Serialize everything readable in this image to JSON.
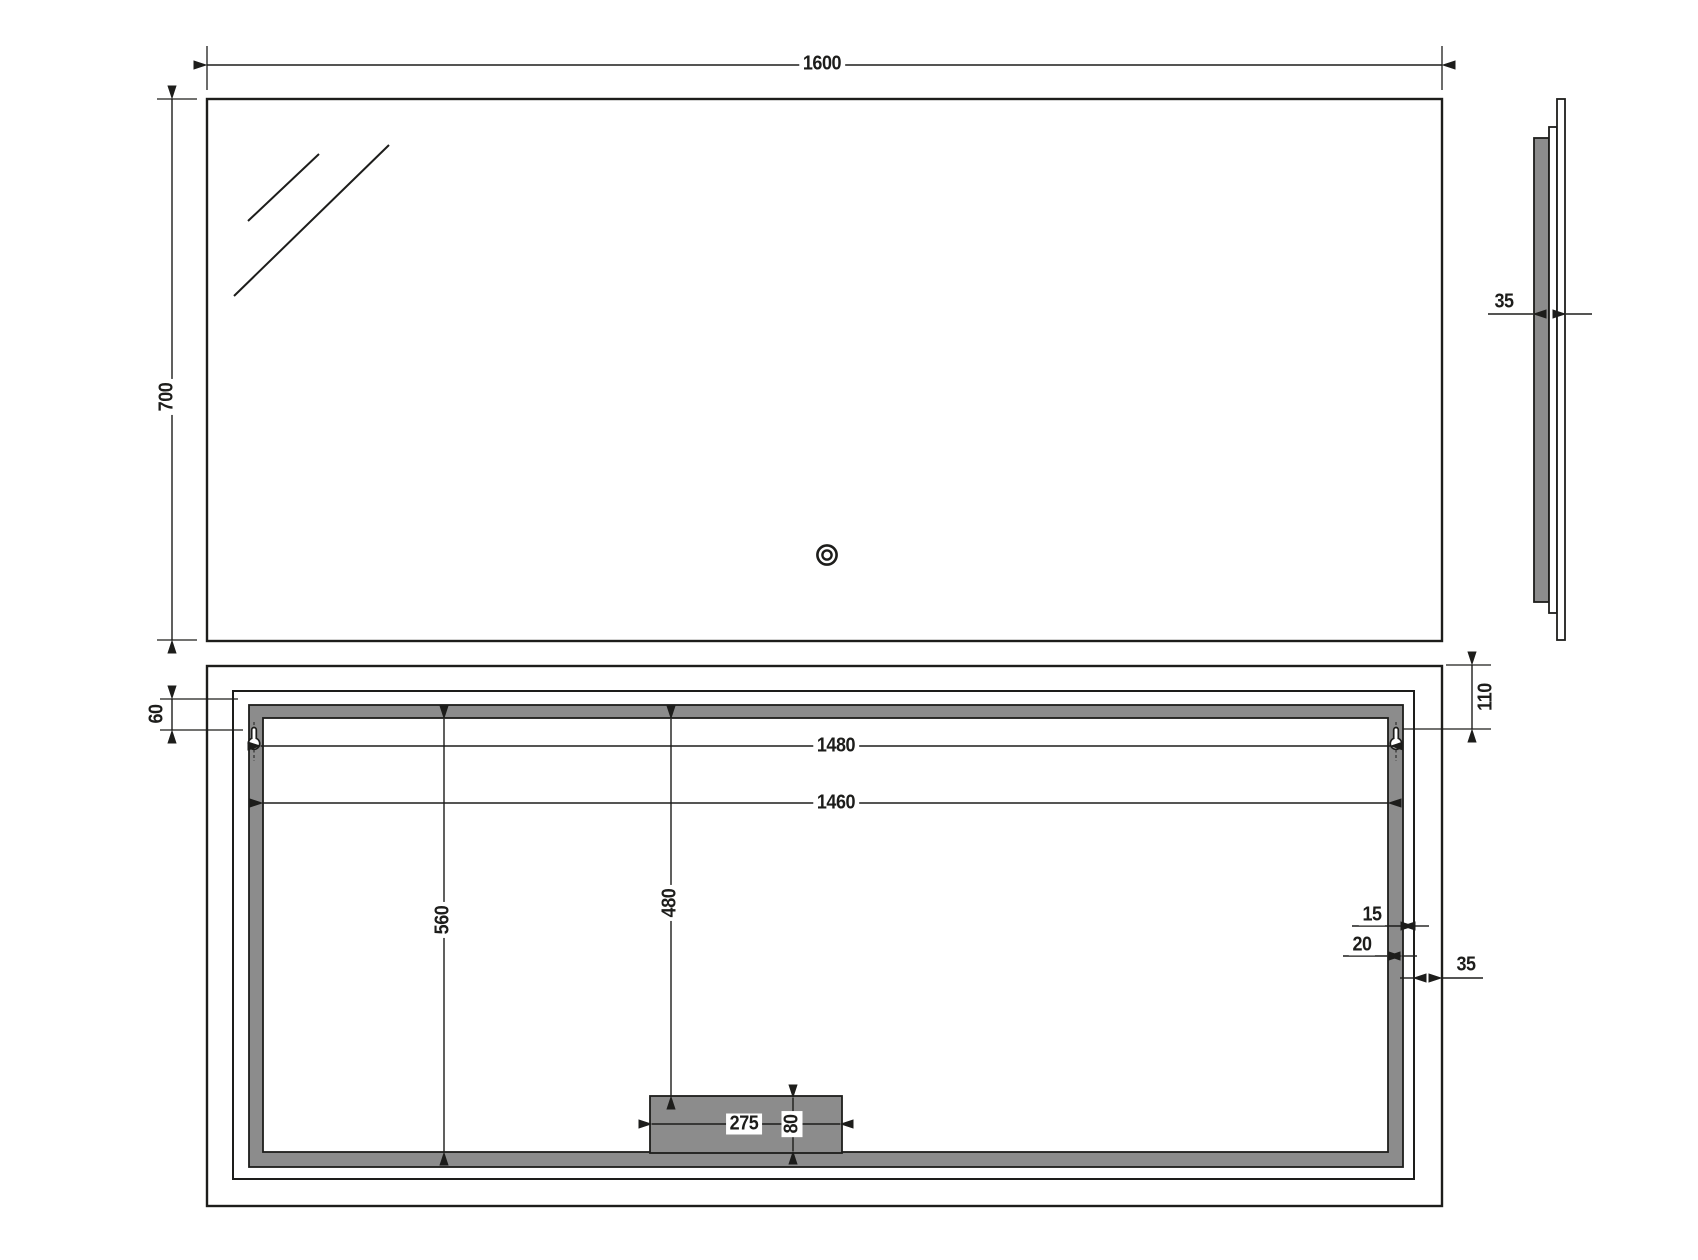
{
  "meta": {
    "type": "technical-drawing",
    "subject": "LED bathroom mirror, three orthographic views (front, side, rear)"
  },
  "colors": {
    "line": "#1d1d1b",
    "gray_fill": "#8c8c8c",
    "background": "#ffffff"
  },
  "front": {
    "width": "1600",
    "height": "700"
  },
  "side": {
    "thickness": "35"
  },
  "rear": {
    "hanger_spacing": "1480",
    "frame_inner_width": "1460",
    "frame_inner_height": "560",
    "box_top_offset": "480",
    "box_width": "275",
    "box_height": "80",
    "hanger_top_offset": "60",
    "hanger_edge_offset": "110",
    "frame_gap": "15",
    "frame_band_width": "20",
    "edge_margin": "35"
  }
}
